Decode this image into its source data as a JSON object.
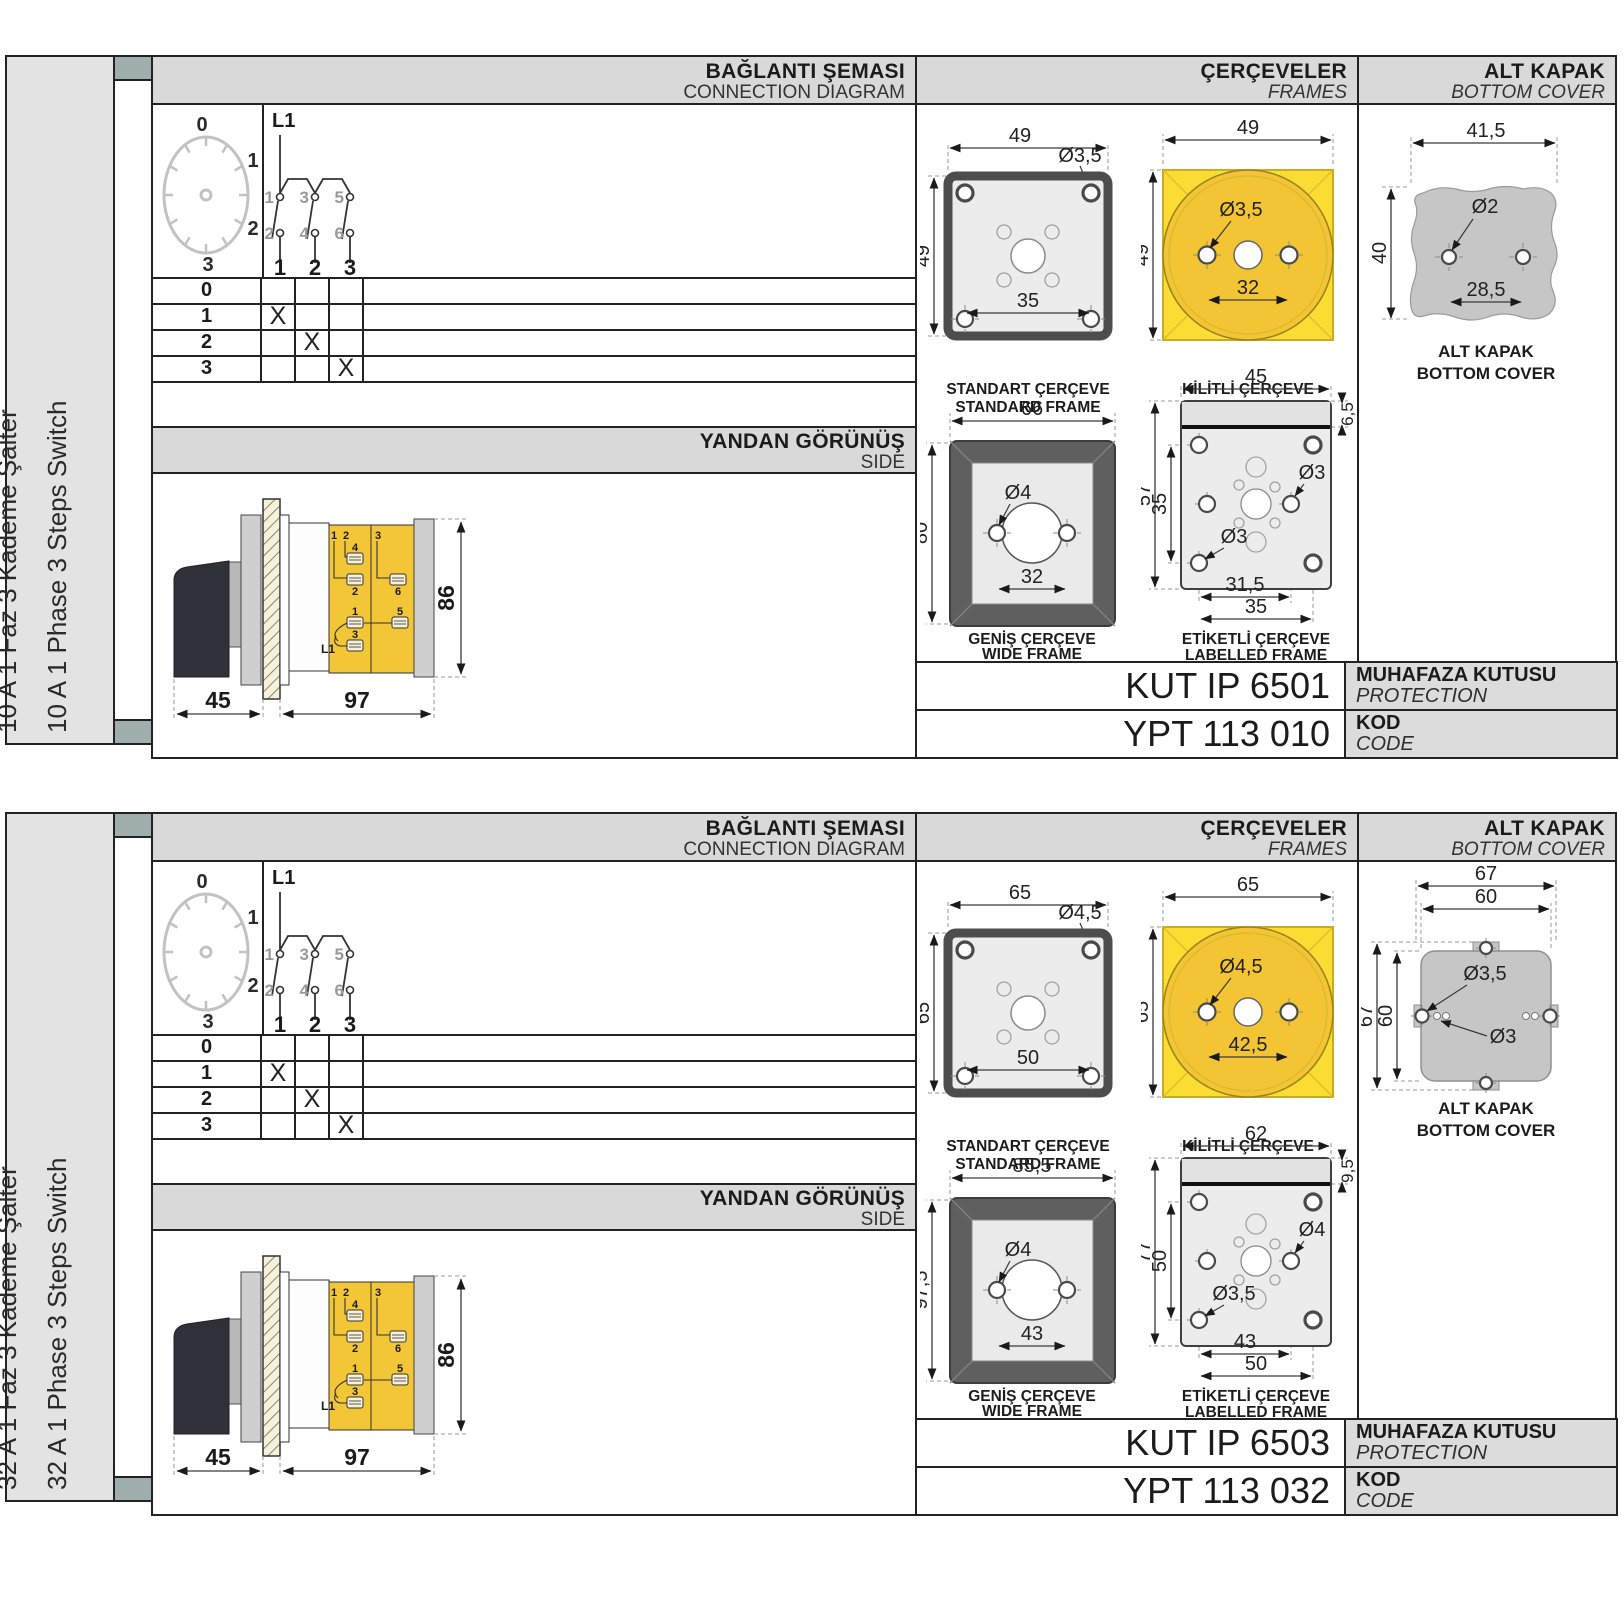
{
  "panels": [
    {
      "variant": "blob",
      "sidebar": {
        "title_tr": "10 A 1 Faz 3 Kademe Şalter",
        "title_en": "10 A 1 Phase 3 Steps Switch"
      },
      "headers": {
        "connection_tr": "BAĞLANTI ŞEMASI",
        "connection_en": "CONNECTION DIAGRAM",
        "frames_tr": "ÇERÇEVELER",
        "frames_en": "FRAMES",
        "cover_tr": "ALT KAPAK",
        "cover_en": "BOTTOM COVER",
        "side_tr": "YANDAN GÖRÜNÜŞ",
        "side_en": "SIDE"
      },
      "dial": {
        "p0": "0",
        "p1": "1",
        "p2": "2",
        "p3": "3"
      },
      "circuit": {
        "l1": "L1",
        "t1": "1",
        "t3": "3",
        "t5": "5",
        "b2": "2",
        "b4": "4",
        "b6": "6",
        "p1": "1",
        "p2": "2",
        "p3": "3"
      },
      "table": {
        "rows": [
          {
            "label": "0",
            "c1": "",
            "c2": "",
            "c3": ""
          },
          {
            "label": "1",
            "c1": "X",
            "c2": "",
            "c3": ""
          },
          {
            "label": "2",
            "c1": "",
            "c2": "X",
            "c3": ""
          },
          {
            "label": "3",
            "c1": "",
            "c2": "",
            "c3": "X"
          }
        ]
      },
      "side_view": {
        "dims": {
          "front": "45",
          "body": "97",
          "height": "86"
        },
        "labels": {
          "n1": "1",
          "n2": "2",
          "n3": "3",
          "n4": "4",
          "nb2": "2",
          "nb6": "6",
          "nb1": "1",
          "nb5": "5",
          "nb3": "3",
          "l1": "L1"
        }
      },
      "frames": {
        "standard": {
          "dim_w": "49",
          "dim_h": "49",
          "dia": "Ø3,5",
          "dim_holes": "35",
          "caption_tr": "STANDART ÇERÇEVE",
          "caption_en": "STANDARD FRAME"
        },
        "padlock": {
          "dim_w": "49",
          "dim_h": "49",
          "dia": "Ø3,5",
          "dim_holes": "32",
          "caption_tr": "KİLİTLİ ÇERÇEVE",
          "caption_en": "PADLOCK FRAME"
        },
        "wide": {
          "dim_w": "66",
          "dim_h": "80",
          "dia": "Ø4",
          "dim_holes": "32",
          "caption_tr": "GENİŞ ÇERÇEVE",
          "caption_en": "WIDE FRAME"
        },
        "labelled": {
          "dim_w": "45",
          "dim_label_h": "6,5",
          "dim_h": "57",
          "dim_inner_h": "35",
          "dia_mid": "Ø3",
          "dia_corner": "Ø3",
          "dim_holes_inner": "31,5",
          "dim_holes_outer": "35",
          "caption_tr": "ETİKETLİ ÇERÇEVE",
          "caption_en": "LABELLED FRAME"
        }
      },
      "cover": {
        "dim_w": "41,5",
        "dim_h": "40",
        "dia": "Ø2",
        "dim_holes": "28,5",
        "caption_tr": "ALT KAPAK",
        "caption_en": "BOTTOM COVER"
      },
      "codes": {
        "enclosure_code": "KUT IP 6501",
        "enclosure_tr": "MUHAFAZA KUTUSU",
        "enclosure_en": "PROTECTION ENCLOSURE",
        "code_value": "YPT 113 010",
        "code_tr": "KOD",
        "code_en": "CODE"
      }
    },
    {
      "variant": "tabs",
      "sidebar": {
        "title_tr": "32 A 1 Faz 3 Kademe Şalter",
        "title_en": "32 A 1 Phase 3 Steps Switch"
      },
      "headers": {
        "connection_tr": "BAĞLANTI ŞEMASI",
        "connection_en": "CONNECTION DIAGRAM",
        "frames_tr": "ÇERÇEVELER",
        "frames_en": "FRAMES",
        "cover_tr": "ALT KAPAK",
        "cover_en": "BOTTOM COVER",
        "side_tr": "YANDAN GÖRÜNÜŞ",
        "side_en": "SIDE"
      },
      "dial": {
        "p0": "0",
        "p1": "1",
        "p2": "2",
        "p3": "3"
      },
      "circuit": {
        "l1": "L1",
        "t1": "1",
        "t3": "3",
        "t5": "5",
        "b2": "2",
        "b4": "4",
        "b6": "6",
        "p1": "1",
        "p2": "2",
        "p3": "3"
      },
      "table": {
        "rows": [
          {
            "label": "0",
            "c1": "",
            "c2": "",
            "c3": ""
          },
          {
            "label": "1",
            "c1": "X",
            "c2": "",
            "c3": ""
          },
          {
            "label": "2",
            "c1": "",
            "c2": "X",
            "c3": ""
          },
          {
            "label": "3",
            "c1": "",
            "c2": "",
            "c3": "X"
          }
        ]
      },
      "side_view": {
        "dims": {
          "front": "45",
          "body": "97",
          "height": "86"
        },
        "labels": {
          "n1": "1",
          "n2": "2",
          "n3": "3",
          "n4": "4",
          "nb2": "2",
          "nb6": "6",
          "nb1": "1",
          "nb5": "5",
          "nb3": "3",
          "l1": "L1"
        }
      },
      "frames": {
        "standard": {
          "dim_w": "65",
          "dim_h": "65",
          "dia": "Ø4,5",
          "dim_holes": "50",
          "caption_tr": "STANDART ÇERÇEVE",
          "caption_en": "STANDARD FRAME"
        },
        "padlock": {
          "dim_w": "65",
          "dim_h": "65",
          "dia": "Ø4,5",
          "dim_holes": "42,5",
          "caption_tr": "KİLİTLİ ÇERÇEVE",
          "caption_en": "PADLOCK FRAME"
        },
        "wide": {
          "dim_w": "85,5",
          "dim_h": "97,5",
          "dia": "Ø4",
          "dim_holes": "43",
          "caption_tr": "GENİŞ ÇERÇEVE",
          "caption_en": "WIDE FRAME"
        },
        "labelled": {
          "dim_w": "62",
          "dim_label_h": "9,5",
          "dim_h": "77",
          "dim_inner_h": "50",
          "dia_mid": "Ø4",
          "dia_corner": "Ø3,5",
          "dim_holes_inner": "43",
          "dim_holes_outer": "50",
          "caption_tr": "ETİKETLİ ÇERÇEVE",
          "caption_en": "LABELLED FRAME"
        }
      },
      "cover": {
        "dim_w_outer": "67",
        "dim_w_inner": "60",
        "dim_h_outer": "67",
        "dim_h_inner": "60",
        "dia_tab": "Ø3,5",
        "dia_dot": "Ø3",
        "caption_tr": "ALT KAPAK",
        "caption_en": "BOTTOM COVER"
      },
      "codes": {
        "enclosure_code": "KUT IP 6503",
        "enclosure_tr": "MUHAFAZA KUTUSU",
        "enclosure_en": "PROTECTION ENCLOSURE",
        "code_value": "YPT 113 032",
        "code_tr": "KOD",
        "code_en": "CODE"
      }
    }
  ]
}
